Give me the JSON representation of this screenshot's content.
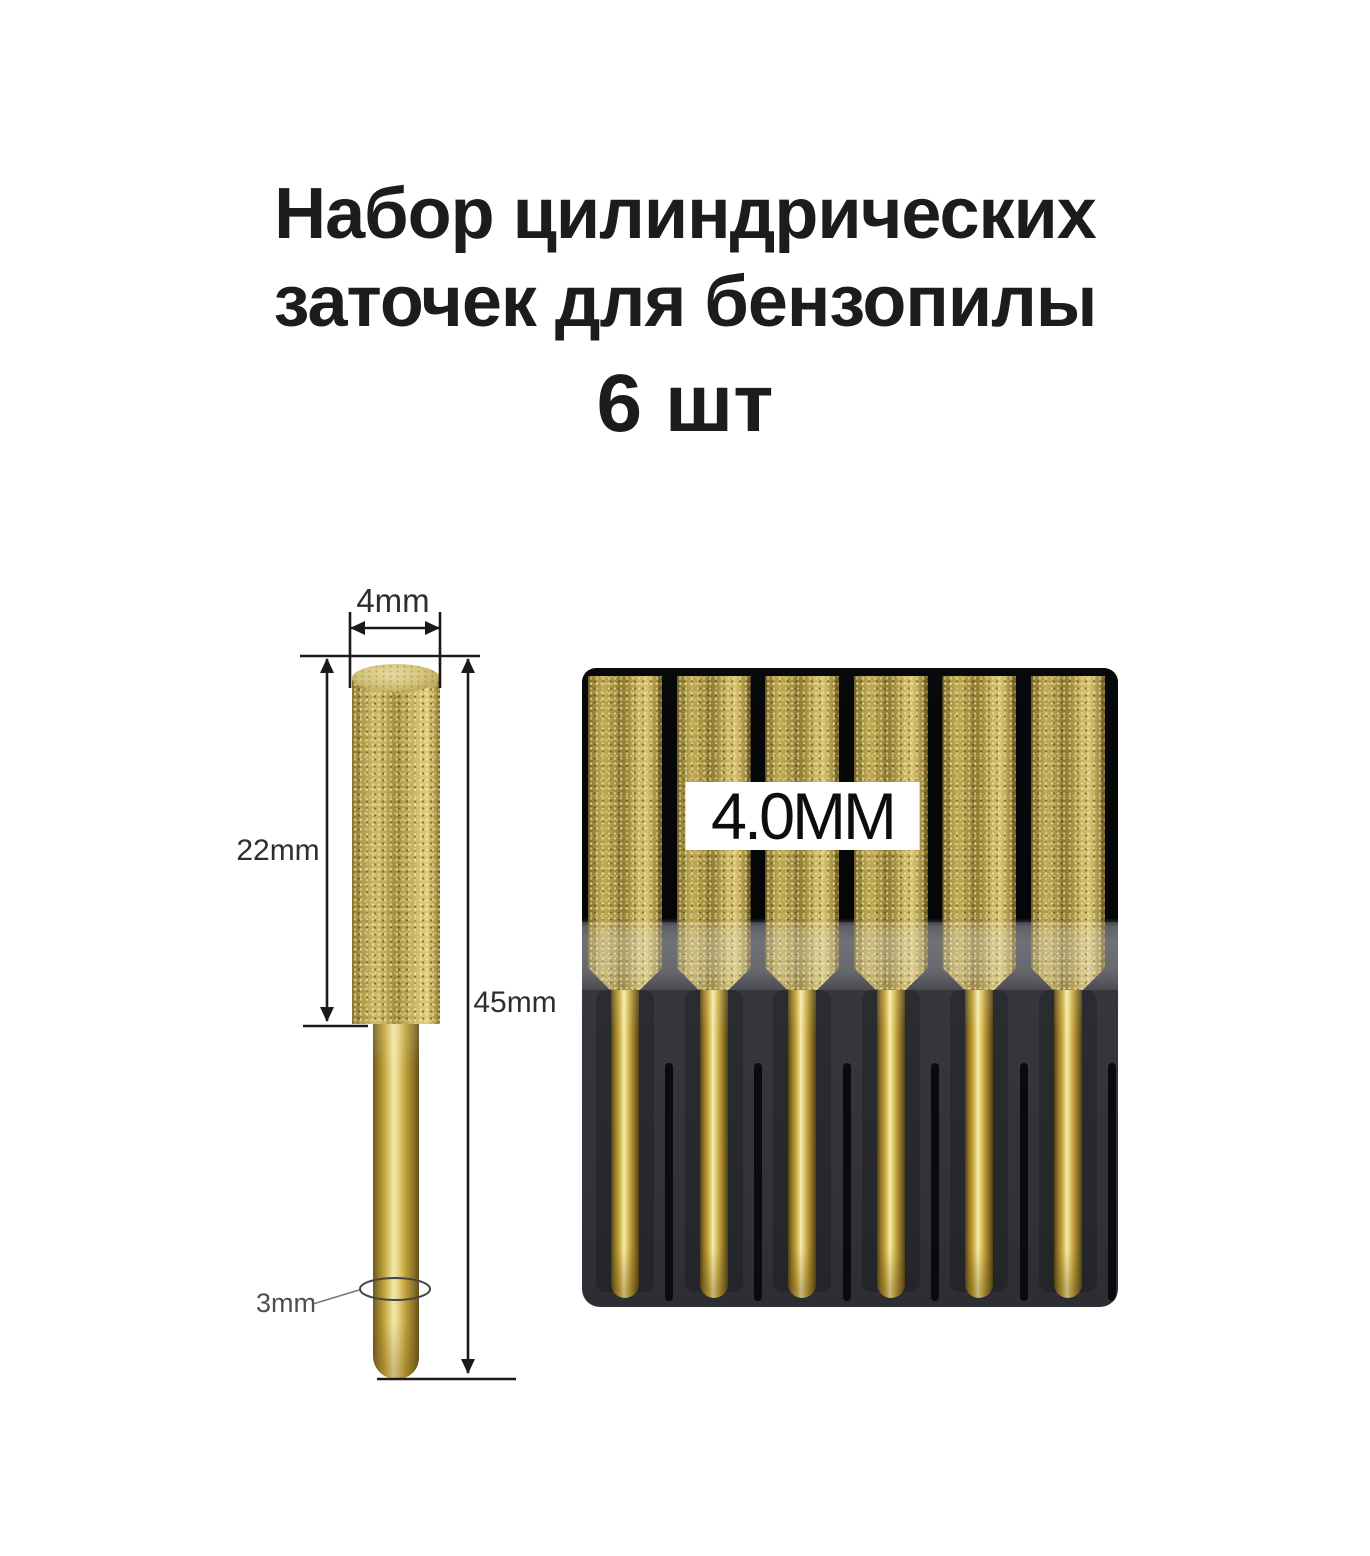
{
  "title": {
    "line1": "Набор цилиндрических",
    "line2": "заточек для бензопилы",
    "count": "6 шт"
  },
  "diagram": {
    "head_diameter": "4mm",
    "head_length": "22mm",
    "total_length": "45mm",
    "shank_diameter": "3mm"
  },
  "photo": {
    "size_label": "4.0MM",
    "bits_count": 6
  },
  "colors": {
    "background": "#ffffff",
    "title_text": "#1c1c1c",
    "dim_text": "#2e2e2e",
    "dim_text_light": "#4f4f4f",
    "line_color": "#1a1a1a",
    "package_black": "#060607",
    "tray_gray": "#35373c",
    "groove_black": "#0a0b0e",
    "label_bg": "#ffffff",
    "label_text": "#0d0d0d",
    "gold_base": "#b7a252",
    "gold_light": "#e9dca0",
    "gold_dark": "#6f5c24",
    "shank_highlight": "#f6ecb4"
  }
}
